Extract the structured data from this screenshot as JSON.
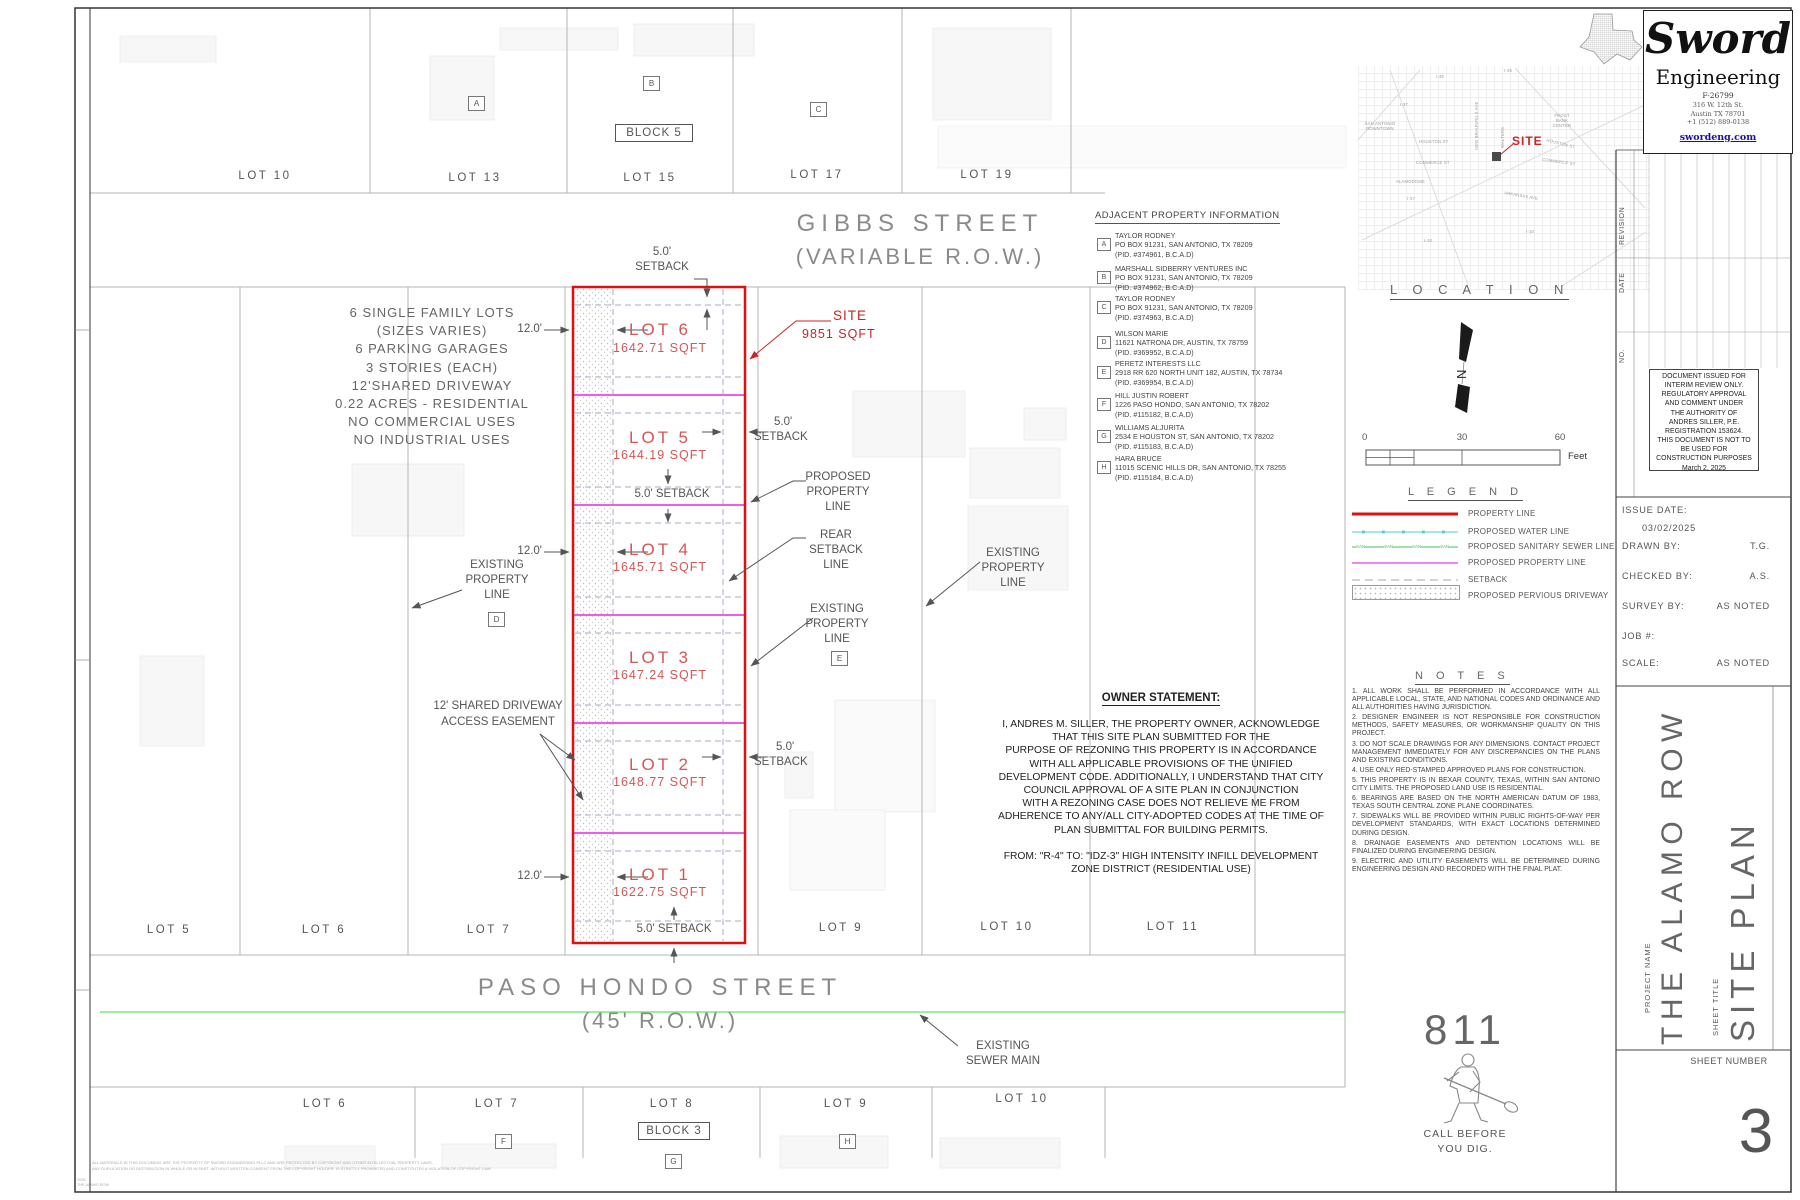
{
  "streets": {
    "gibbs_name": "GIBBS STREET",
    "gibbs_row": "(VARIABLE R.O.W.)",
    "paso_name": "PASO HONDO STREET",
    "paso_row": "(45' R.O.W.)"
  },
  "top_lots": [
    "LOT 10",
    "LOT 13",
    "LOT 15",
    "LOT 17",
    "LOT 19"
  ],
  "mid_lots": [
    "LOT 5",
    "LOT 6",
    "LOT 7",
    "LOT 9",
    "LOT 10",
    "LOT 11"
  ],
  "bottom_lots": [
    "LOT 6",
    "LOT 7",
    "LOT 8",
    "LOT 9",
    "LOT 10"
  ],
  "blocks": {
    "b5": "BLOCK 5",
    "b3": "BLOCK 3"
  },
  "markers": {
    "a": "A",
    "b": "B",
    "c": "C",
    "d": "D",
    "e": "E",
    "f": "F",
    "g": "G",
    "h": "H"
  },
  "info": {
    "lines": [
      "6 SINGLE FAMILY LOTS",
      "(SIZES VARIES)",
      "6 PARKING GARAGES",
      "3 STORIES (EACH)",
      "12'SHARED DRIVEWAY",
      "0.22 ACRES - RESIDENTIAL",
      "NO COMMERCIAL USES",
      "NO INDUSTRIAL USES"
    ]
  },
  "site": {
    "lots": [
      {
        "name": "LOT 6",
        "area": "1642.71 SQFT"
      },
      {
        "name": "LOT 5",
        "area": "1644.19 SQFT"
      },
      {
        "name": "LOT 4",
        "area": "1645.71 SQFT"
      },
      {
        "name": "LOT 3",
        "area": "1647.24 SQFT"
      },
      {
        "name": "LOT 2",
        "area": "1648.77 SQFT"
      },
      {
        "name": "LOT 1",
        "area": "1622.75 SQFT"
      }
    ],
    "callout_title": "SITE",
    "callout_area": "9851 SQFT",
    "dim12": "12.0'",
    "dim5": "5.0'",
    "setback_word": "SETBACK",
    "setback_full": "5.0' SETBACK"
  },
  "callouts": {
    "existing_pl": [
      "EXISTING",
      "PROPERTY",
      "LINE"
    ],
    "proposed_pl": [
      "PROPOSED",
      "PROPERTY",
      "LINE"
    ],
    "rear": [
      "REAR",
      "SETBACK",
      "LINE"
    ],
    "driveway1": "12' SHARED DRIVEWAY",
    "driveway2": "ACCESS EASEMENT",
    "sewer1": "EXISTING",
    "sewer2": "SEWER MAIN"
  },
  "adjacent": {
    "title": "ADJACENT PROPERTY INFORMATION",
    "entries": [
      {
        "id": "A",
        "name": "TAYLOR RODNEY",
        "address": "PO BOX 91231, SAN ANTONIO, TX 78209",
        "pid": "(PID. #374961, B.C.A.D)"
      },
      {
        "id": "B",
        "name": "MARSHALL SIDBERRY VENTURES INC",
        "address": "PO BOX 91231, SAN ANTONIO, TX 78209",
        "pid": "(PID. #374962, B.C.A.D)"
      },
      {
        "id": "C",
        "name": "TAYLOR RODNEY",
        "address": "PO BOX 91231, SAN ANTONIO, TX 78209",
        "pid": "(PID. #374963, B.C.A.D)"
      },
      {
        "id": "D",
        "name": "WILSON MARIE",
        "address": "11621 NATRONA DR, AUSTIN, TX 78759",
        "pid": "(PID. #369952, B.C.A.D)"
      },
      {
        "id": "E",
        "name": "PERETZ INTERESTS LLC",
        "address": "2918 RR 620 NORTH UNIT 182, AUSTIN, TX 78734",
        "pid": "(PID. #369954, B.C.A.D)"
      },
      {
        "id": "F",
        "name": "HILL JUSTIN ROBERT",
        "address": "1226 PASO HONDO, SAN ANTONIO, TX 78202",
        "pid": "(PID. #115182, B.C.A.D)"
      },
      {
        "id": "G",
        "name": "WILLIAMS ALJURITA",
        "address": "2534 E HOUSTON ST, SAN ANTONIO, TX 78202",
        "pid": "(PID. #115183, B.C.A.D)"
      },
      {
        "id": "H",
        "name": "HARA BRUCE",
        "address": "11015 SCENIC HILLS DR, SAN ANTONIO, TX 78255",
        "pid": "(PID. #115184, B.C.A.D)"
      }
    ]
  },
  "map": {
    "title": "L O C A T I O N",
    "site_label": "SITE",
    "north_letter": "N",
    "labels": [
      "SAN ANTONIO DOWNTOWN",
      "I-35",
      "I-35",
      "I-37",
      "I-37",
      "HOUSTON ST",
      "HOUSTON ST",
      "COMMERCE ST",
      "COMMERCE ST",
      "NEW BRAUNFELS AVE",
      "WALTERS",
      "FROST BANK CENTER",
      "ARKANSAS AVE",
      "ALAMODOME",
      "I-10",
      "I-10"
    ]
  },
  "scalebar": {
    "n0": "0",
    "n30": "30",
    "n60": "60",
    "unit": "Feet"
  },
  "legend": {
    "title": "L E G E N D",
    "san": "SAN",
    "items": [
      "PROPERTY LINE",
      "PROPOSED WATER LINE",
      "PROPOSED SANITARY SEWER LINE",
      "PROPOSED PROPERTY LINE",
      "SETBACK",
      "PROPOSED PERVIOUS DRIVEWAY"
    ]
  },
  "owner": {
    "title": "OWNER STATEMENT:",
    "body": [
      "I, ANDRES M. SILLER, THE PROPERTY OWNER, ACKNOWLEDGE",
      "THAT THIS SITE PLAN SUBMITTED FOR THE",
      "PURPOSE OF REZONING THIS PROPERTY IS IN ACCORDANCE",
      "WITH ALL APPLICABLE PROVISIONS OF THE UNIFIED",
      "DEVELOPMENT CODE. ADDITIONALLY, I UNDERSTAND THAT CITY",
      "COUNCIL APPROVAL OF A SITE PLAN IN CONJUNCTION",
      "WITH A REZONING CASE DOES NOT RELIEVE ME FROM",
      "ADHERENCE TO ANY/ALL CITY-ADOPTED CODES AT THE TIME OF",
      "PLAN SUBMITTAL FOR BUILDING PERMITS."
    ],
    "from": [
      "FROM: \"R-4\" TO: \"IDZ-3\" HIGH INTENSITY INFILL DEVELOPMENT",
      "ZONE DISTRICT (RESIDENTIAL USE)"
    ]
  },
  "notes": {
    "title": "N O T E S",
    "items": [
      "1. ALL WORK SHALL BE PERFORMED IN ACCORDANCE WITH ALL APPLICABLE LOCAL, STATE, AND NATIONAL CODES AND ORDINANCE AND ALL AUTHORITIES HAVING JURISDICTION.",
      "2. DESIGNER ENGINEER IS NOT RESPONSIBLE FOR CONSTRUCTION METHODS, SAFETY MEASURES, OR WORKMANSHIP QUALITY ON THIS PROJECT.",
      "3. DO NOT SCALE DRAWINGS FOR ANY DIMENSIONS. CONTACT PROJECT MANAGEMENT IMMEDIATELY FOR ANY DISCREPANCIES ON THE PLANS AND EXISTING CONDITIONS.",
      "4. USE ONLY RED-STAMPED APPROVED PLANS FOR CONSTRUCTION.",
      "5. THIS PROPERTY IS IN BEXAR COUNTY, TEXAS, WITHIN SAN ANTONIO CITY LIMITS. THE PROPOSED LAND USE IS RESIDENTIAL.",
      "6. BEARINGS ARE BASED ON THE NORTH AMERICAN DATUM OF 1983, TEXAS SOUTH CENTRAL ZONE PLANE COORDINATES.",
      "7. SIDEWALKS WILL BE PROVIDED WITHIN PUBLIC RIGHTS-OF-WAY PER DEVELOPMENT STANDARDS, WITH EXACT LOCATIONS DETERMINED DURING DESIGN.",
      "8. DRAINAGE EASEMENTS AND DETENTION LOCATIONS WILL BE FINALIZED DURING ENGINEERING DESIGN.",
      "9. ELECTRIC AND UTILITY EASEMENTS WILL BE DETERMINED DURING ENGINEERING DESIGN AND RECORDED WITH THE FINAL PLAT."
    ]
  },
  "dig": {
    "number": "811",
    "line1": "CALL BEFORE",
    "line2": "YOU DIG."
  },
  "titleblock": {
    "firm": "S​word",
    "firm2": "Engineering",
    "reg": "F-26799",
    "addr1": "316 W. 12th St.",
    "addr2": "Austin TX 78701",
    "phone": "+1 (512) 889-0138",
    "site_url": "swordeng.com",
    "revision": "REVISION",
    "date": "DATE",
    "no": "NO.",
    "interim": [
      "DOCUMENT ISSUED FOR",
      "INTERIM REVIEW ONLY.",
      "REGULATORY APPROVAL",
      "AND COMMENT UNDER",
      "THE AUTHORITY OF",
      "ANDRES SILLER, P.E.",
      "REGISTRATION 153624.",
      "THIS DOCUMENT IS NOT TO",
      "BE USED FOR",
      "CONSTRUCTION PURPOSES",
      "March 2, 2025"
    ],
    "fields": {
      "issue_label": "ISSUE DATE:",
      "issue_value": "03/02/2025",
      "drawn_label": "DRAWN BY:",
      "drawn_value": "T.G.",
      "checked_label": "CHECKED BY:",
      "checked_value": "A.S.",
      "survey_label": "SURVEY BY:",
      "survey_value": "AS NOTED",
      "job_label": "JOB #:",
      "scale_label": "SCALE:",
      "scale_value": "AS NOTED"
    },
    "project_label": "PROJECT NAME",
    "project_name": "THE ALAMO ROW",
    "sheet_title_label": "SHEET TITLE",
    "sheet_title": "SITE PLAN",
    "sheet_number_label": "SHEET NUMBER",
    "sheet_number": "3"
  },
  "fine_print": {
    "l1": "ALL MATERIALS IN THIS DOCUMENT ARE THE PROPERTY OF SWORD ENGINEERING PLLC AND ARE PROTECTED BY COPYRIGHT AND OTHER INTELLECTUAL PROPERTY LAWS.",
    "l2": "ANY DUPLICATION OR DISTRIBUTION IN WHOLE OR IN PART, WITHOUT WRITTEN CONSENT FROM THE COPYRIGHT HOLDER, IS STRICTLY PROHIBITED AND CONSTITUTES A VIOLATION OF COPYRIGHT LAW.",
    "c1": "2025",
    "c2": "THE ALAMO ROW"
  },
  "colors": {
    "property_line": "#e01010",
    "proposed_water_line": "#72d9dd",
    "proposed_sanitary_sewer_line": "#44c54c",
    "proposed_property_line": "#ea5fea",
    "setback": "#b5b9c8",
    "existing_sewer_main": "#7ae87a",
    "lot_text_red": "#d85555",
    "callout_red": "#cc2222",
    "link_blue": "#1a0dab"
  }
}
